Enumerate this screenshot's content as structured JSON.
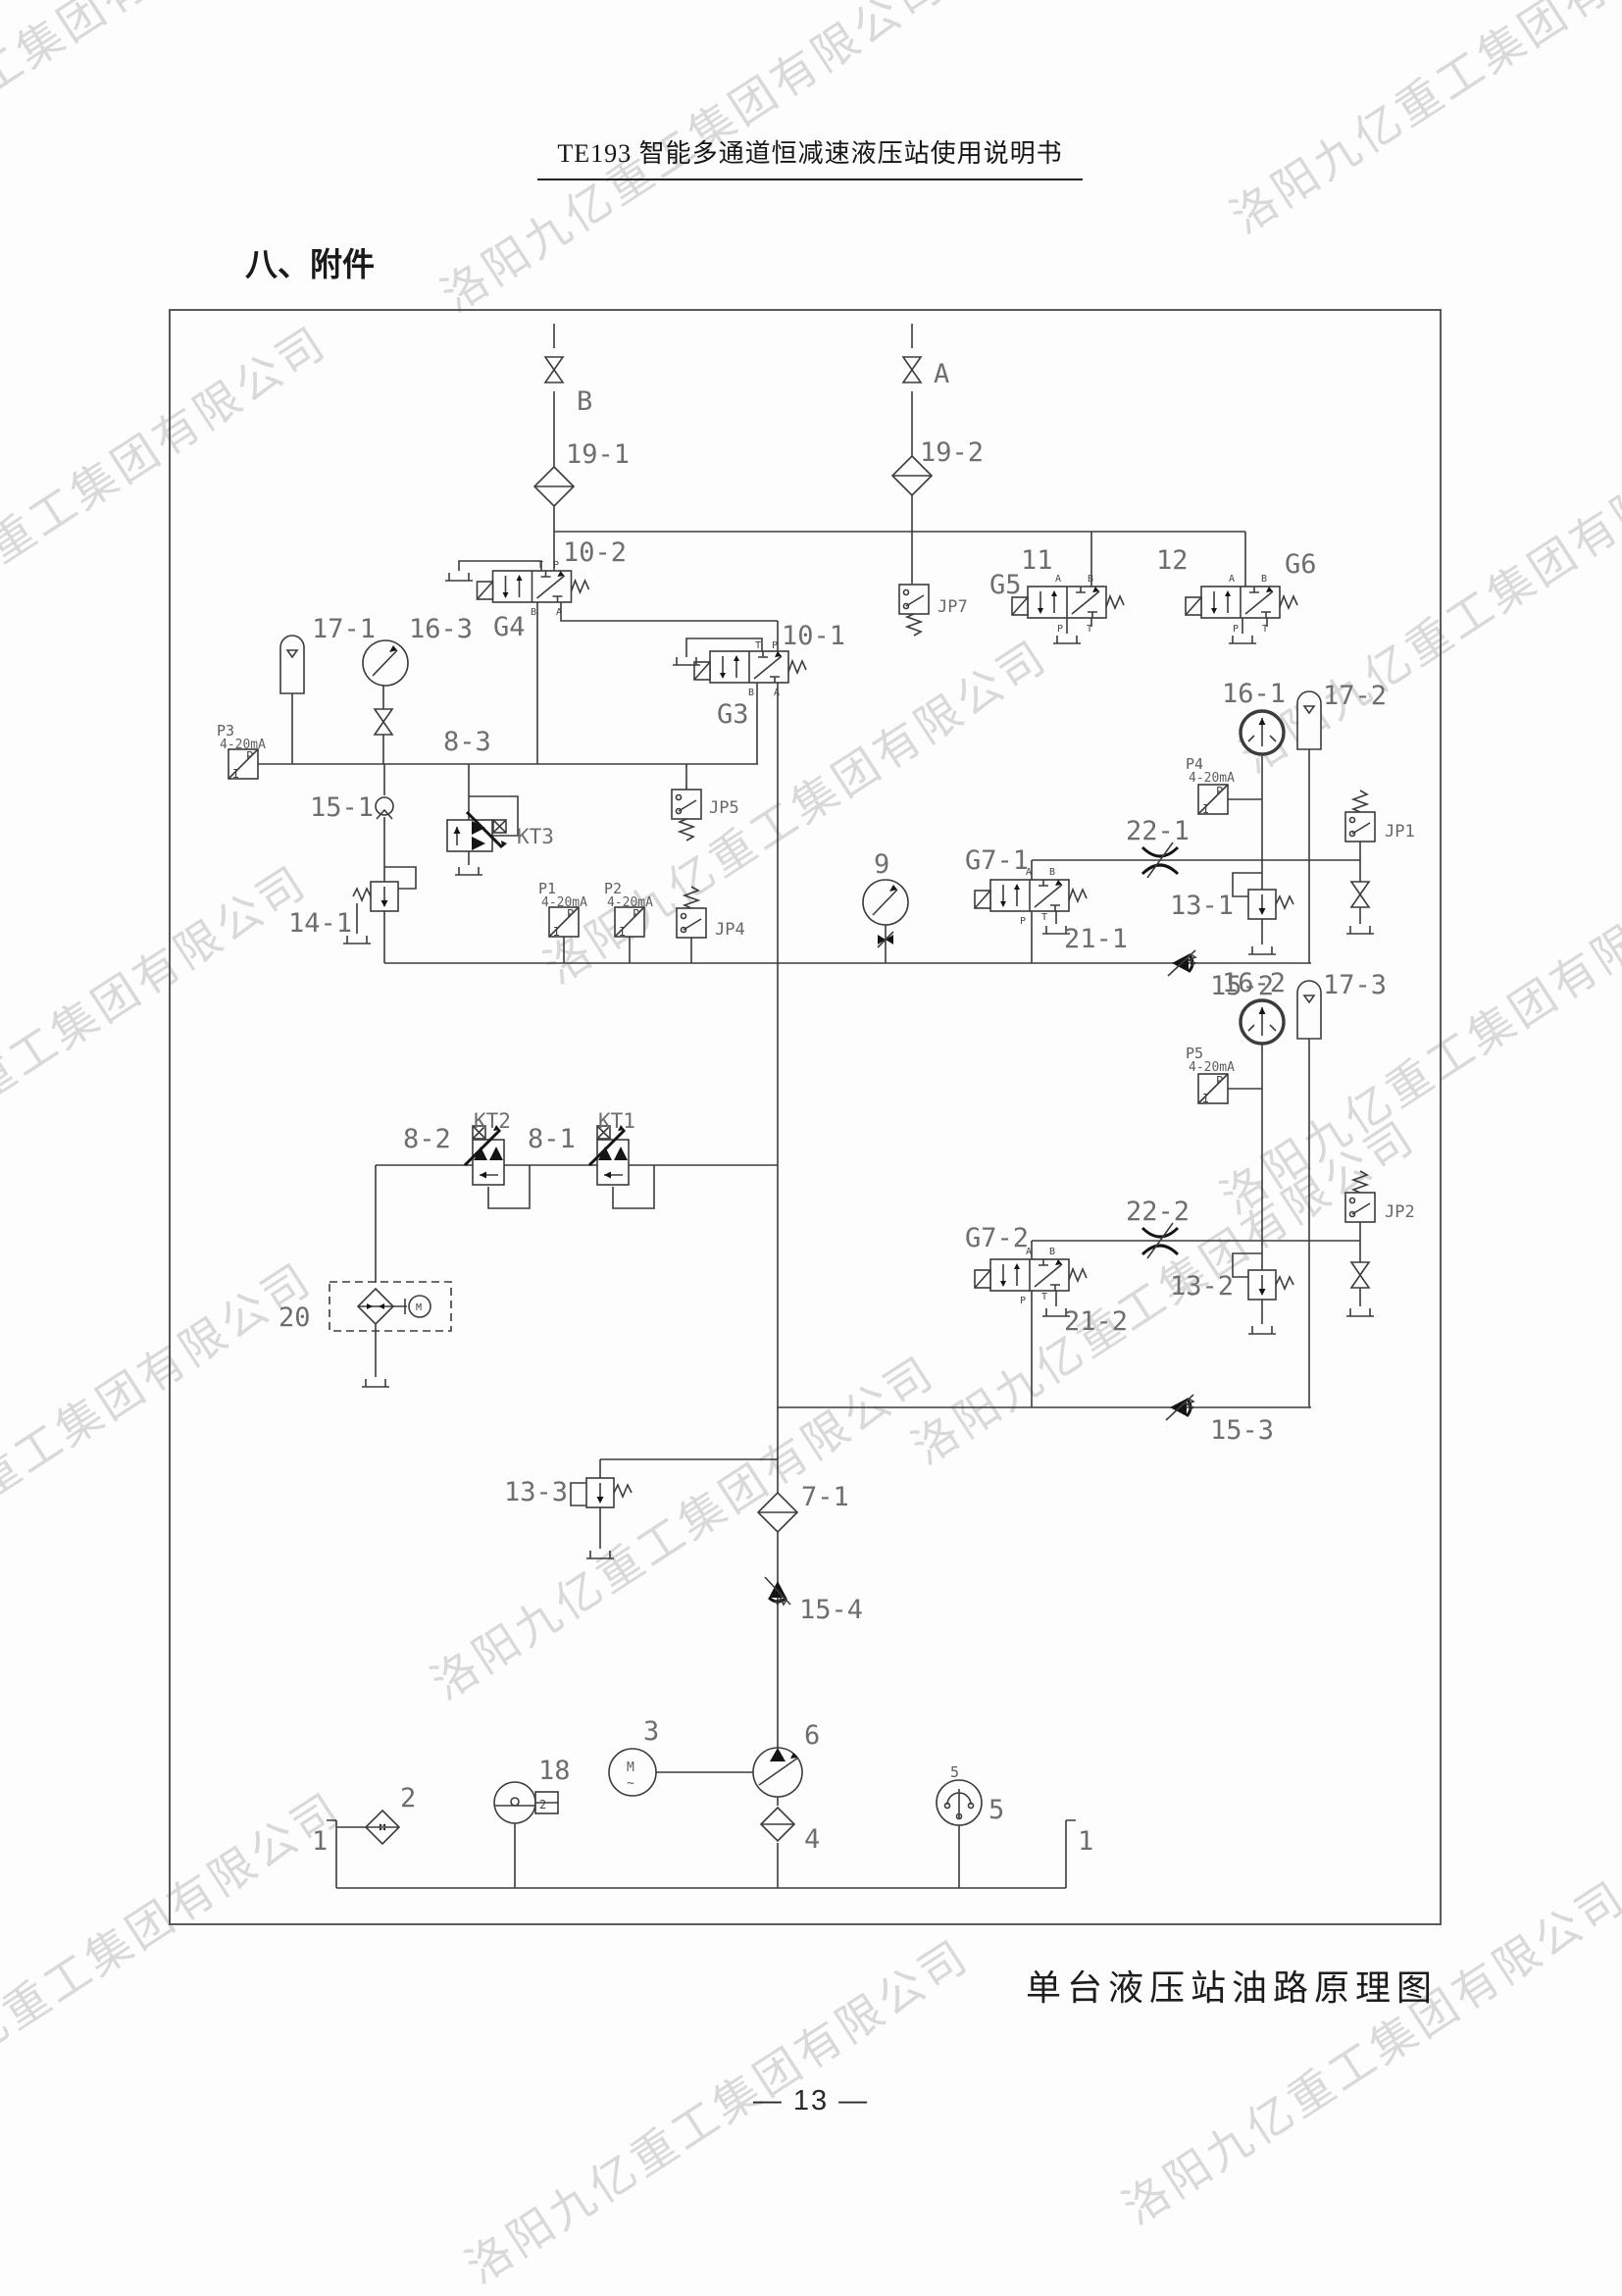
{
  "page": {
    "header_title": "TE193 智能多通道恒减速液压站使用说明书",
    "section_title": "八、附件",
    "caption": "单台液压站油路原理图",
    "page_number": "— 13 —",
    "watermark": "洛阳九亿重工集团有限公司"
  },
  "diagram": {
    "labels": {
      "b": "B",
      "a": "A",
      "n19_1": "19-1",
      "n19_2": "19-2",
      "n10_2": "10-2",
      "g4": "G4",
      "n10_1": "10-1",
      "g3": "G3",
      "n11": "11",
      "g5": "G5",
      "n12": "12",
      "g6": "G6",
      "jp7": "JP7",
      "n17_1": "17-1",
      "n16_3": "16-3",
      "n8_3": "8-3",
      "p3": "P3",
      "ma": "4-20mA",
      "n15_1": "15-1",
      "kt3": "KT3",
      "n14_1": "14-1",
      "jp5": "JP5",
      "p1": "P1",
      "p2": "P2",
      "jp4": "JP4",
      "n9": "9",
      "n16_1": "16-1",
      "n17_2": "17-2",
      "p4": "P4",
      "n22_1": "22-1",
      "jp1": "JP1",
      "g7_1": "G7-1",
      "n21_1": "21-1",
      "n13_1": "13-1",
      "n15_2": "15-2",
      "n16_2": "16-2",
      "n17_3": "17-3",
      "p5": "P5",
      "n22_2": "22-2",
      "jp2": "JP2",
      "g7_2": "G7-2",
      "n21_2": "21-2",
      "n13_2": "13-2",
      "n15_3": "15-3",
      "n8_2": "8-2",
      "kt2": "KT2",
      "n8_1": "8-1",
      "kt1": "KT1",
      "n20": "20",
      "n13_3": "13-3",
      "n7_1": "7-1",
      "n15_4": "15-4",
      "n1": "1",
      "n2": "2",
      "n18": "18",
      "n3": "3",
      "n6": "6",
      "n4": "4",
      "n5": "5"
    },
    "ports": {
      "a": "A",
      "b": "B",
      "p": "P",
      "t": "T",
      "pp": "P",
      "i": "I",
      "m": "M",
      "tilde": "~",
      "lvl": "2"
    }
  }
}
